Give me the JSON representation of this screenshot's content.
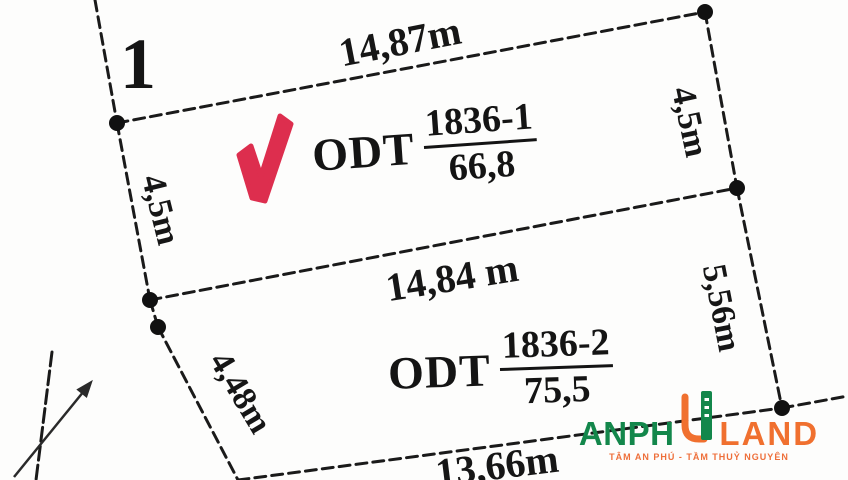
{
  "meta": {
    "type": "cadastral parcel sketch"
  },
  "colors": {
    "line": "#1a1a1a",
    "check_red": "#dd2e4e",
    "logo_green": "#13874b",
    "logo_orange": "#f0702f",
    "background": "#fdfdfc"
  },
  "icons": {
    "checkmark": "red-checkmark-icon",
    "north_arrow": "direction-arrow-icon",
    "logo_building": "anphu-u-building-icon"
  },
  "point_label": "1",
  "dimensions": {
    "top": "14,87m",
    "right_upper": "4,5m",
    "left_upper": "4,5m",
    "middle": "14,84 m",
    "left_lower": "4,48m",
    "right_lower": "5,56m",
    "bottom": "13,66m"
  },
  "parcels": [
    {
      "land_use_code": "ODT",
      "parcel_number": "1836-1",
      "area": "66,8",
      "checked": true
    },
    {
      "land_use_code": "ODT",
      "parcel_number": "1836-2",
      "area": "75,5",
      "checked": false
    }
  ],
  "logo": {
    "name_part1": "ANPH",
    "name_part2": "U",
    "name_part3": "LAND",
    "tagline": "TÂM AN PHÚ - TẦM THUỶ NGUYÊN"
  }
}
